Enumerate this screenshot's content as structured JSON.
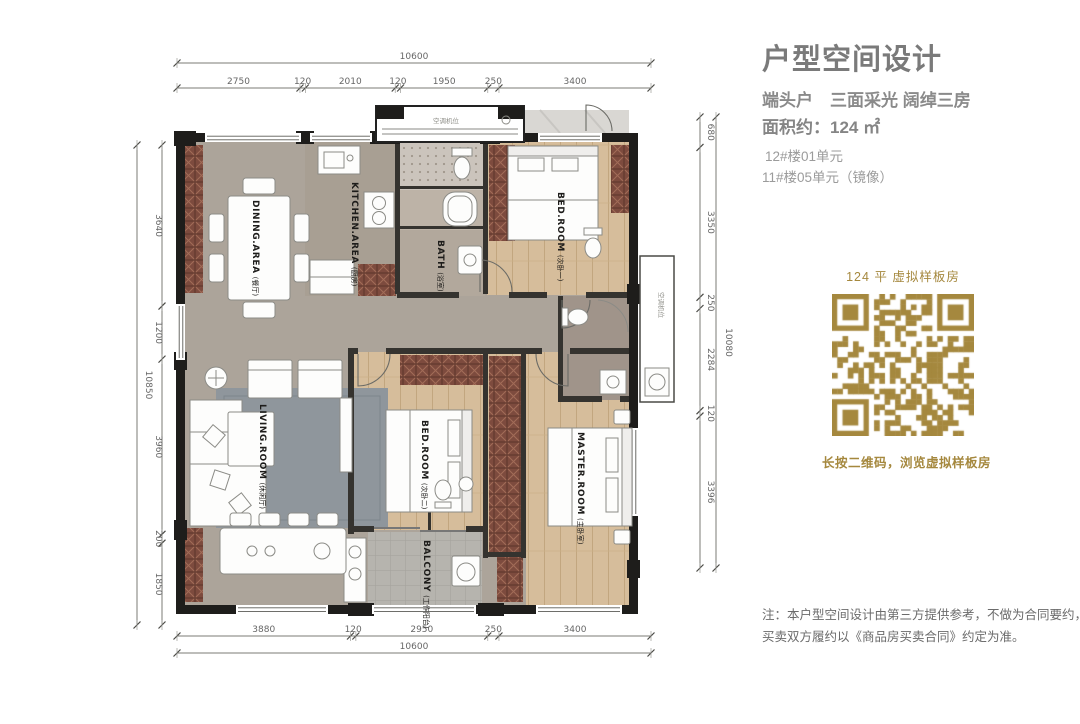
{
  "panel": {
    "title": "户型空间设计",
    "subtitle": "端头户　三面采光 阔绰三房",
    "area_label": "面积约：124 ㎡",
    "unit_line1": "12#楼01单元",
    "unit_line2": "11#楼05单元（镜像）",
    "qr": {
      "caption_top": "124 平  虚拟样板房",
      "caption_bottom": "长按二维码，浏览虚拟样板房"
    },
    "note_line1": "注：本户型空间设计由第三方提供参考，不做为合同要约，",
    "note_line2": "买卖双方履约以《商品房买卖合同》约定为准。"
  },
  "plan": {
    "rooms": {
      "dining": {
        "en": "DINING.AREA",
        "zh": "(餐厅)"
      },
      "kitchen": {
        "en": "KITCHEN.AREA",
        "zh": "(厨房)"
      },
      "bath": {
        "en": "BATH",
        "zh": "(浴室)"
      },
      "bedroom1": {
        "en": "BED.ROOM",
        "zh": "(次卧一)"
      },
      "living": {
        "en": "LIVING.ROOM",
        "zh": "(休闲厅)"
      },
      "bedroom2": {
        "en": "BED.ROOM",
        "zh": "(次卧二)"
      },
      "master": {
        "en": "MASTER.ROOM",
        "zh": "(主卧室)"
      },
      "balcony": {
        "en": "BALCONY",
        "zh": "(工作阳台)"
      }
    },
    "annotations": {
      "top_box": "空调机位",
      "side_box": "空调机位"
    },
    "dimensions": {
      "top": {
        "total": "10600",
        "segments": [
          "2750",
          "120",
          "2010",
          "120",
          "1950",
          "250",
          "3400"
        ]
      },
      "bottom": {
        "total": "10600",
        "segments": [
          "3880",
          "120",
          "2950",
          "250",
          "3400"
        ]
      },
      "left": {
        "total": "10850",
        "segments": [
          "3640",
          "1200",
          "3960",
          "200",
          "1850"
        ]
      },
      "right": {
        "total": "10080",
        "segments": [
          "680",
          "3350",
          "250",
          "2284",
          "120",
          "3396"
        ]
      }
    },
    "colors": {
      "gold": "#a5883e",
      "wall": "#1e1d1b",
      "floor": "#aca49a",
      "wood": "#d6bd9b",
      "hatch": "#7d4b3e",
      "tile": "#b6b4ae"
    }
  }
}
